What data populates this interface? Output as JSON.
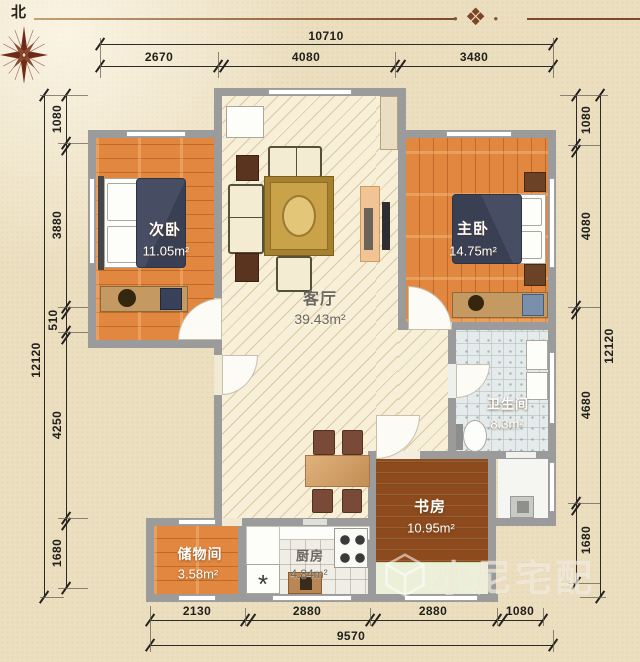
{
  "compass": {
    "north_label": "北"
  },
  "rooms": {
    "secondary_bedroom": {
      "name": "次卧",
      "area": "11.05m²"
    },
    "master_bedroom": {
      "name": "主卧",
      "area": "14.75m²"
    },
    "living_room": {
      "name": "客厅",
      "area": "39.43m²"
    },
    "bathroom": {
      "name": "卫生间",
      "area": "8.3m²"
    },
    "study": {
      "name": "书房",
      "area": "10.95m²"
    },
    "kitchen": {
      "name": "厨房",
      "area": "4.84m²"
    },
    "storage": {
      "name": "储物间",
      "area": "3.58m²"
    }
  },
  "dimensions": {
    "top": {
      "total": "10710",
      "segments": [
        "2670",
        "4080",
        "3480"
      ]
    },
    "bottom": {
      "total": "9570",
      "segments": [
        "2130",
        "2880",
        "2880",
        "1080"
      ]
    },
    "left": {
      "total": "12120",
      "segments": [
        "1080",
        "3880",
        "510",
        "4250",
        "1680"
      ]
    },
    "right": {
      "total": "12120",
      "segments": [
        "1080",
        "4080",
        "4680",
        "1680"
      ]
    }
  },
  "watermark": {
    "text": "小尼宅配"
  },
  "icons": {
    "ornament": "❖",
    "dot": "●",
    "sink_symbol": "*"
  },
  "colors": {
    "wall": "#9b9b9b",
    "wood": "#e2873f",
    "study_wood": "#8d4a1c",
    "ornament_brown": "#7d4426",
    "bed": "#3f4459"
  }
}
